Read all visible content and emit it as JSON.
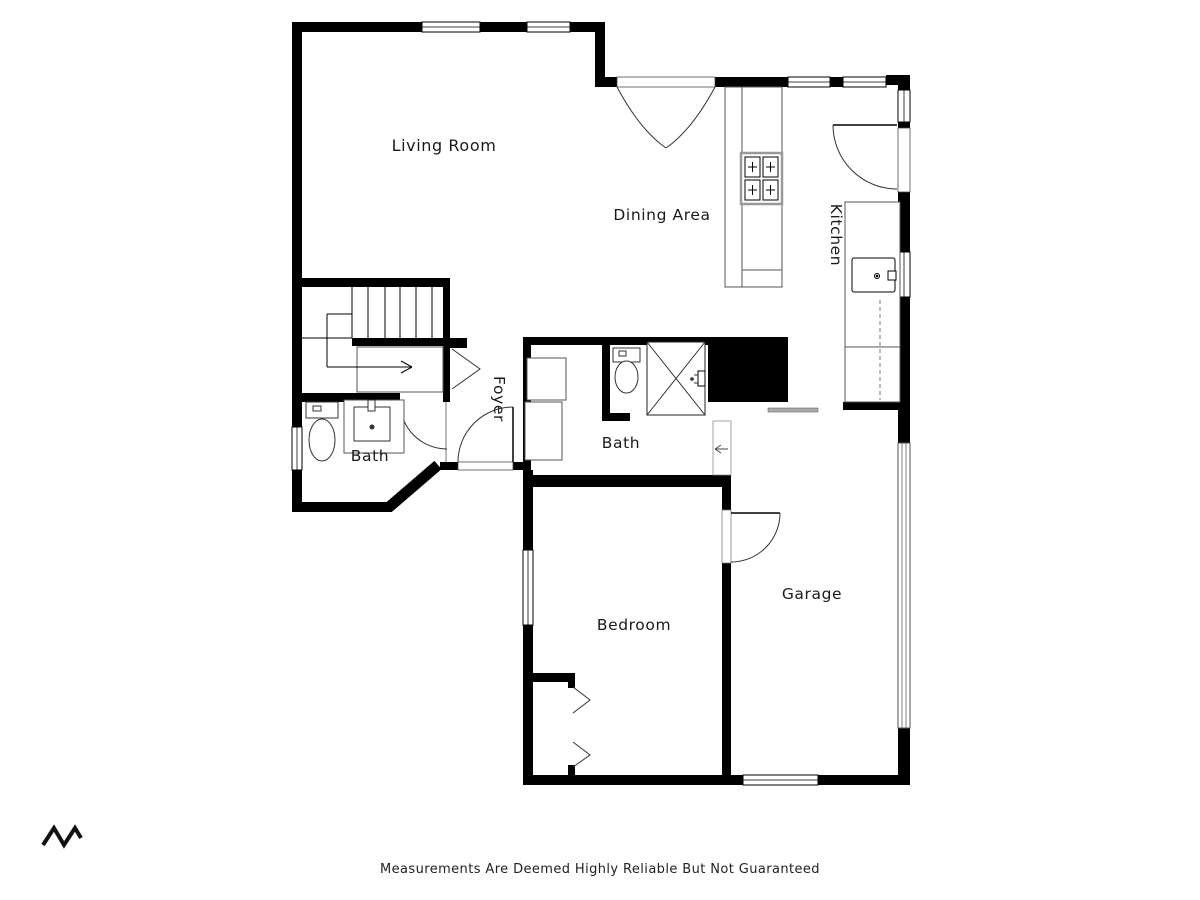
{
  "floorplan": {
    "rooms": {
      "living_room": {
        "label": "Living Room"
      },
      "dining_area": {
        "label": "Dining Area"
      },
      "kitchen": {
        "label": "Kitchen"
      },
      "foyer": {
        "label": "Foyer"
      },
      "bath_left": {
        "label": "Bath"
      },
      "bath_center": {
        "label": "Bath"
      },
      "bedroom": {
        "label": "Bedroom"
      },
      "garage": {
        "label": "Garage"
      }
    },
    "colors": {
      "wall": "#000000",
      "fixture_line": "#555555",
      "text": "#1a1a1a",
      "background": "#ffffff"
    }
  },
  "footer": {
    "disclaimer": "Measurements Are Deemed Highly Reliable But Not Guaranteed"
  }
}
